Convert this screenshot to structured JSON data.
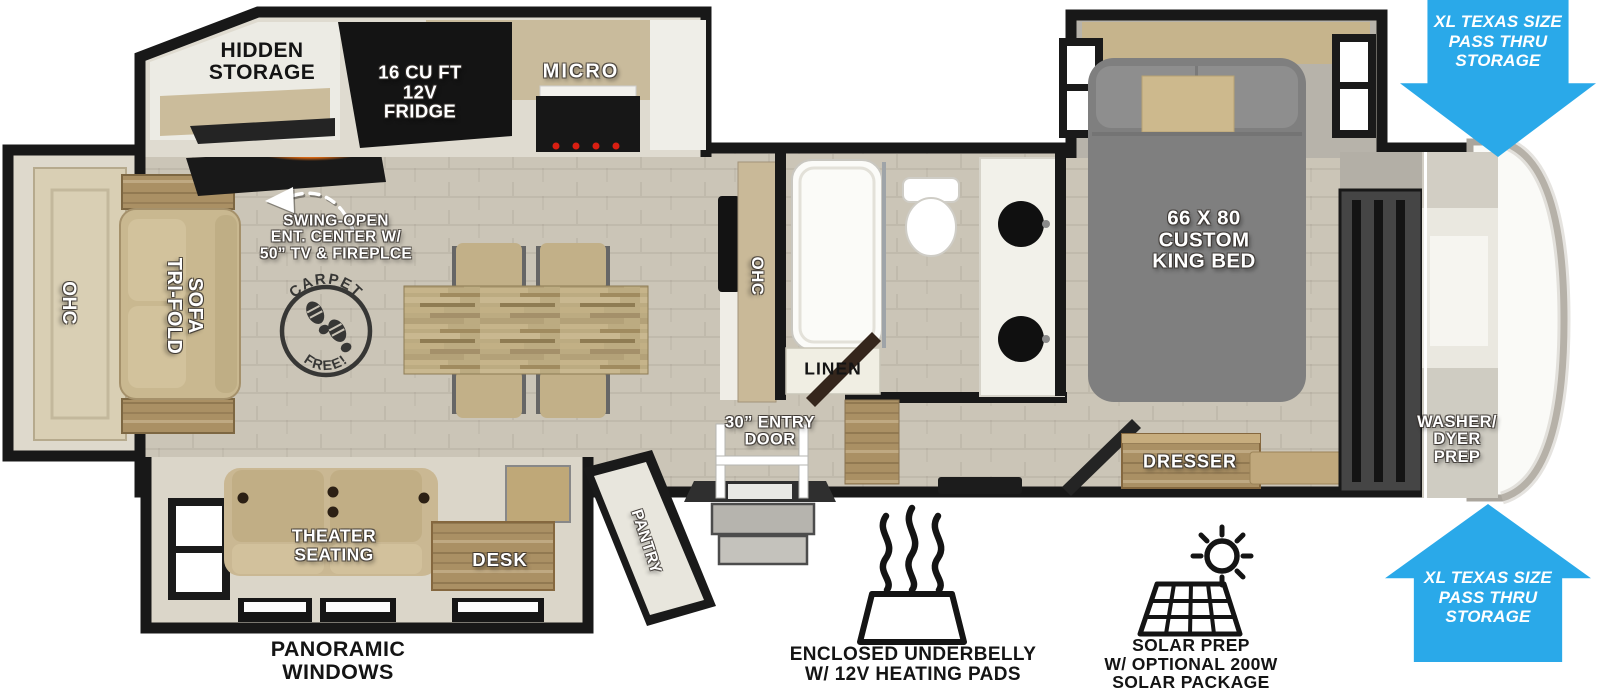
{
  "colors": {
    "arrow_blue": "#2aa9e9",
    "wall": "#181818",
    "floor": "#cbc5b7",
    "slide_floor": "#dbd6c9",
    "wood_light": "#c9b890",
    "wood_dark": "#aa9064",
    "sofa_tan": "#c9b890",
    "bed_gray": "#7f7f7f",
    "appliance_black": "#161616",
    "fixture_white": "#fafaf7"
  },
  "rear_lounge": {
    "ohc_label": "OHC",
    "sofa_label": "TRI-FOLD\nSOFA"
  },
  "kitchen": {
    "hidden_storage_label": "HIDDEN\nSTORAGE",
    "fridge_label": "16 CU FT\n12V\nFRIDGE",
    "micro_label": "MICRO",
    "ent_center_note": "SWING-OPEN\nENT. CENTER W/\n50” TV & FIREPLCE",
    "ohc_label": "OHC",
    "carpet_stamp": {
      "top": "CARPET",
      "bottom": "FREE!"
    }
  },
  "bathroom": {
    "linen_label": "LINEN"
  },
  "bedroom": {
    "bed_label": "66 X 80\nCUSTOM\nKING BED",
    "dresser_label": "DRESSER",
    "washer_dryer_label": "WASHER/\nDYER\nPREP"
  },
  "entry": {
    "door_label": "30” ENTRY\nDOOR"
  },
  "front_lounge": {
    "theater_label": "THEATER\nSEATING",
    "desk_label": "DESK",
    "pantry_label": "PANTRY",
    "windows_label": "PANORAMIC\nWINDOWS"
  },
  "callouts": {
    "pass_thru_top_label": "XL TEXAS SIZE\nPASS THRU\nSTORAGE",
    "pass_thru_bottom_label": "XL TEXAS SIZE\nPASS THRU\nSTORAGE",
    "underbelly_label": "ENCLOSED UNDERBELLY\nW/ 12V HEATING PADS",
    "solar_label": "SOLAR PREP\nW/ OPTIONAL 200W\nSOLAR PACKAGE"
  }
}
